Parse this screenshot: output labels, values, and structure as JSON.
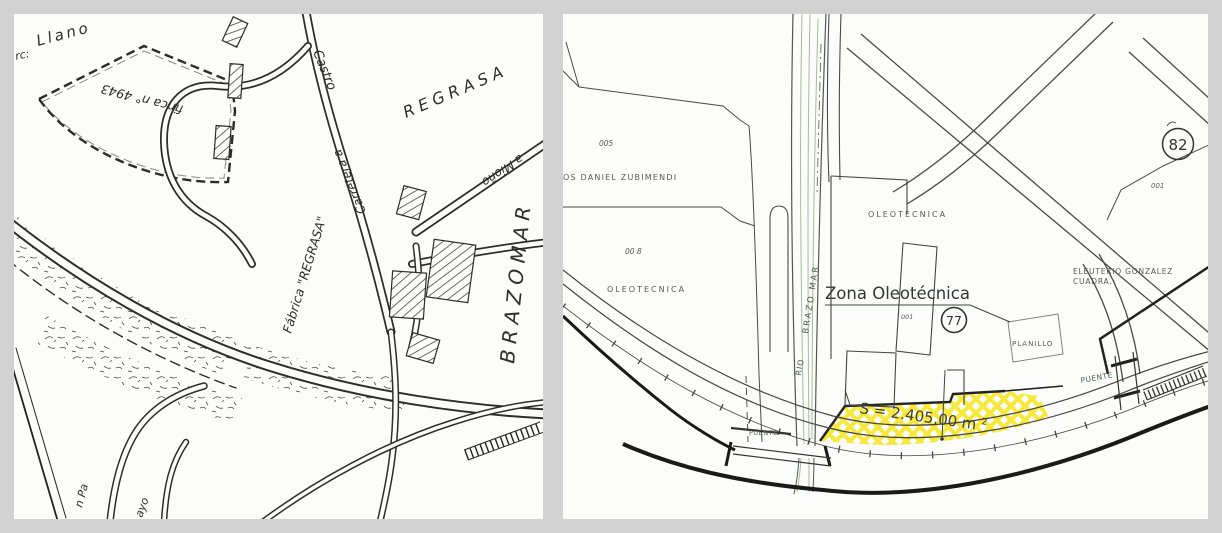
{
  "window": {
    "background": "#d2d2d2",
    "panel_background": "#fcfcfa"
  },
  "left_map": {
    "description": "hand-drawn sketch plan",
    "labels": {
      "llano_prefix": "rc:",
      "llano": "Llano",
      "finca": "finca n° 4943",
      "regrasa_parcel": "REGRASA",
      "castro": "Castro",
      "carretera_a": "Carretera a",
      "a_miono": "a Mioño",
      "fabrica_regrasa": "Fábrica \"REGRASA\"",
      "brazomar": "BRAZOMAR",
      "fragment_campa": "n Pa",
      "fragment_ayo": "ayo"
    }
  },
  "right_map": {
    "description": "cadastral plan with highlighted zone",
    "highlight_color": "#f6e93c",
    "labels": {
      "sheet_number": "82",
      "parcel_001_top": "001",
      "parcel_005": "005",
      "owner_zubimendi": "OS DANIEL ZUBIMENDI",
      "parcel_008": "00 8",
      "oleotecnica_left": "OLEOTECNICA",
      "oleotecnica_mid": "OLEOTECNICA",
      "zona_oleotecnica": "Zona Oleotécnica",
      "parcel_001_mid": "001",
      "plot_number": "77",
      "planillo": "PLANILLO",
      "owner_gonzalez_line1": "ELEUTERIO GONZALEZ",
      "owner_gonzalez_line2": "CUADRA.-",
      "rio": "RIO",
      "brazo_mar": "BRAZO MAR",
      "puente_left": "PUENTE",
      "puente_right": "PUENTE",
      "area_value": "S = 2.405,00 m",
      "area_exponent": "2"
    }
  }
}
